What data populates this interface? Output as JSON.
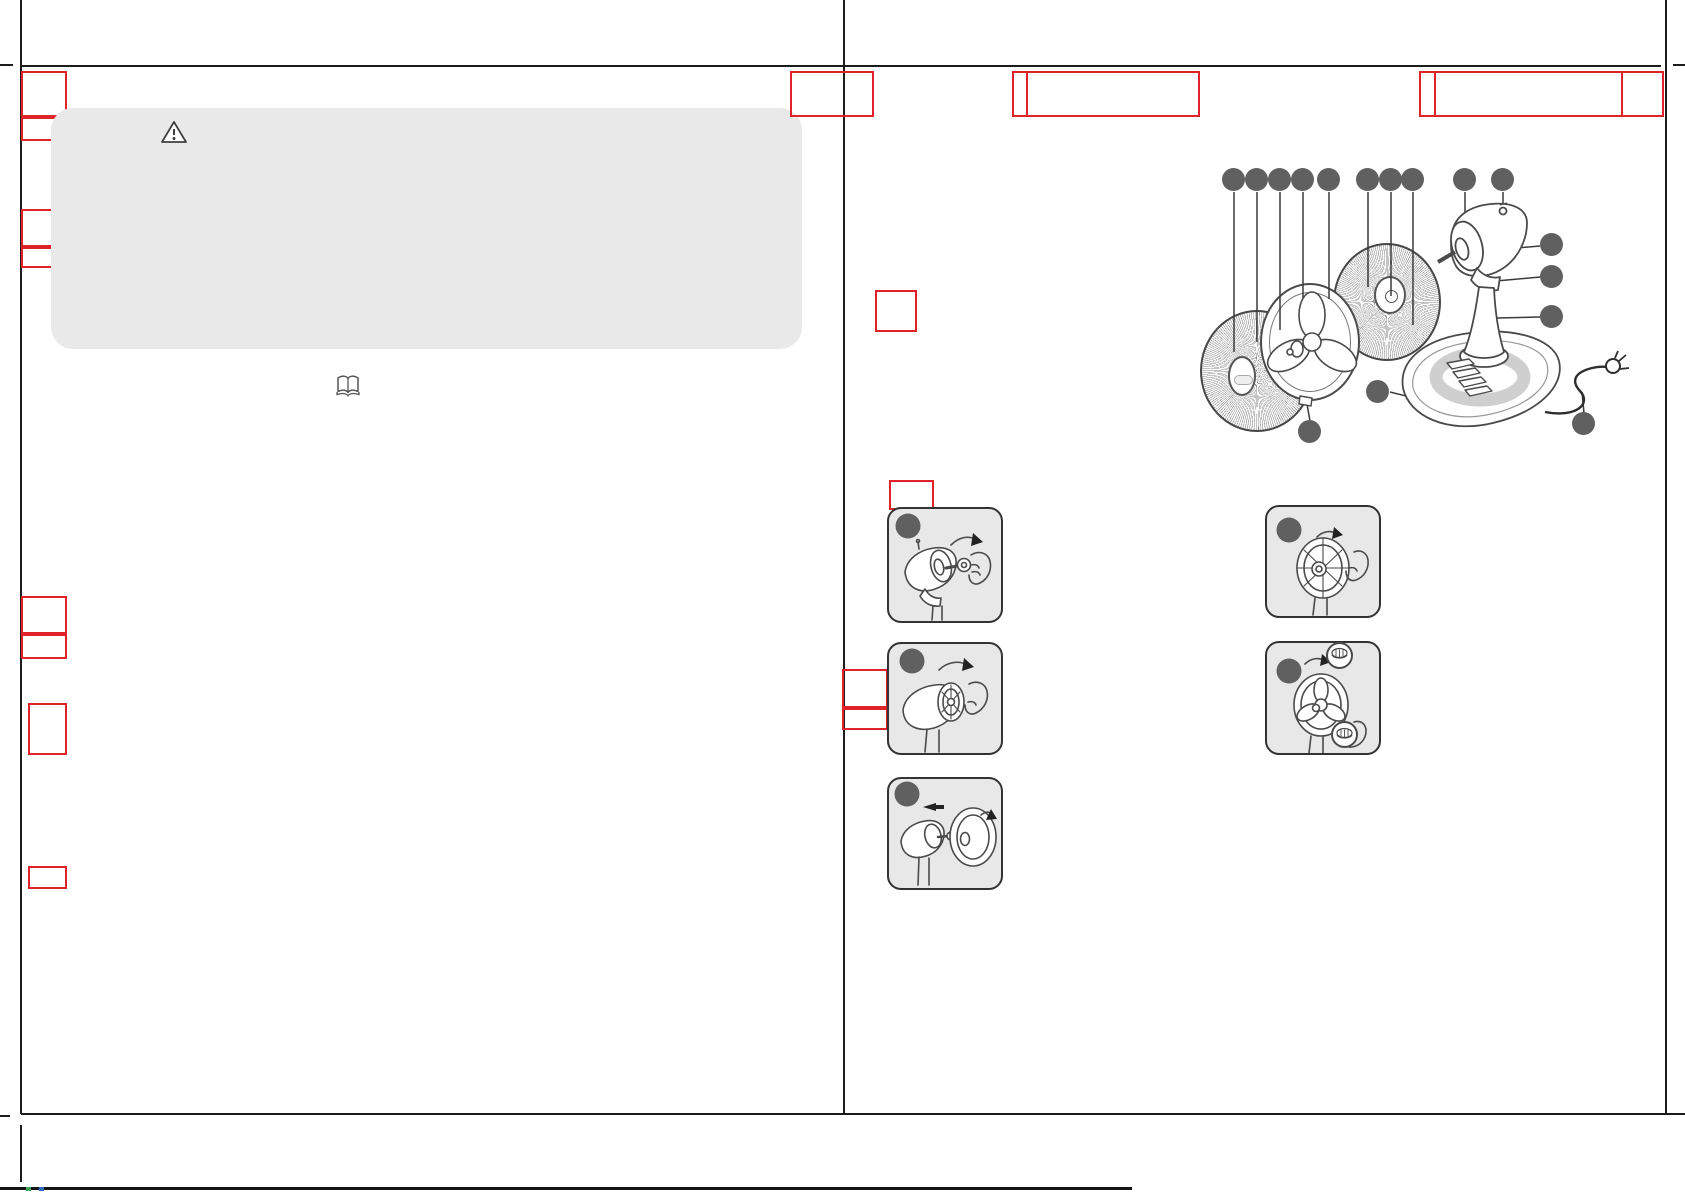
{
  "document": {
    "kind": "instruction-manual-print-spread-desk-fan-template",
    "pages": 2,
    "visible_text": ""
  },
  "colors": {
    "placeholder_red": "#e02229",
    "panel_gray": "#e9e9e9",
    "step_box_gray": "#e8e8e8",
    "callout_dot_gray": "#606060",
    "crop_line": "#1c1c1c",
    "illustration_stroke": "#4a4a4a",
    "reg_green": "#3aa555",
    "reg_blue": "#2f6bbf"
  },
  "left_page": {
    "margin_placeholder_boxes": 8,
    "warning_panel": {
      "icon": "warning-triangle-icon",
      "text": ""
    },
    "manual_icon": "open-book-icon"
  },
  "right_page": {
    "header_placeholder_boxes": 3,
    "section_placeholder_boxes": 4,
    "parts_diagram": {
      "subject": "desk-fan-exploded-view",
      "callout_dots": 16
    },
    "assembly_step_panels": 5,
    "detail_callout_circles": 2
  }
}
